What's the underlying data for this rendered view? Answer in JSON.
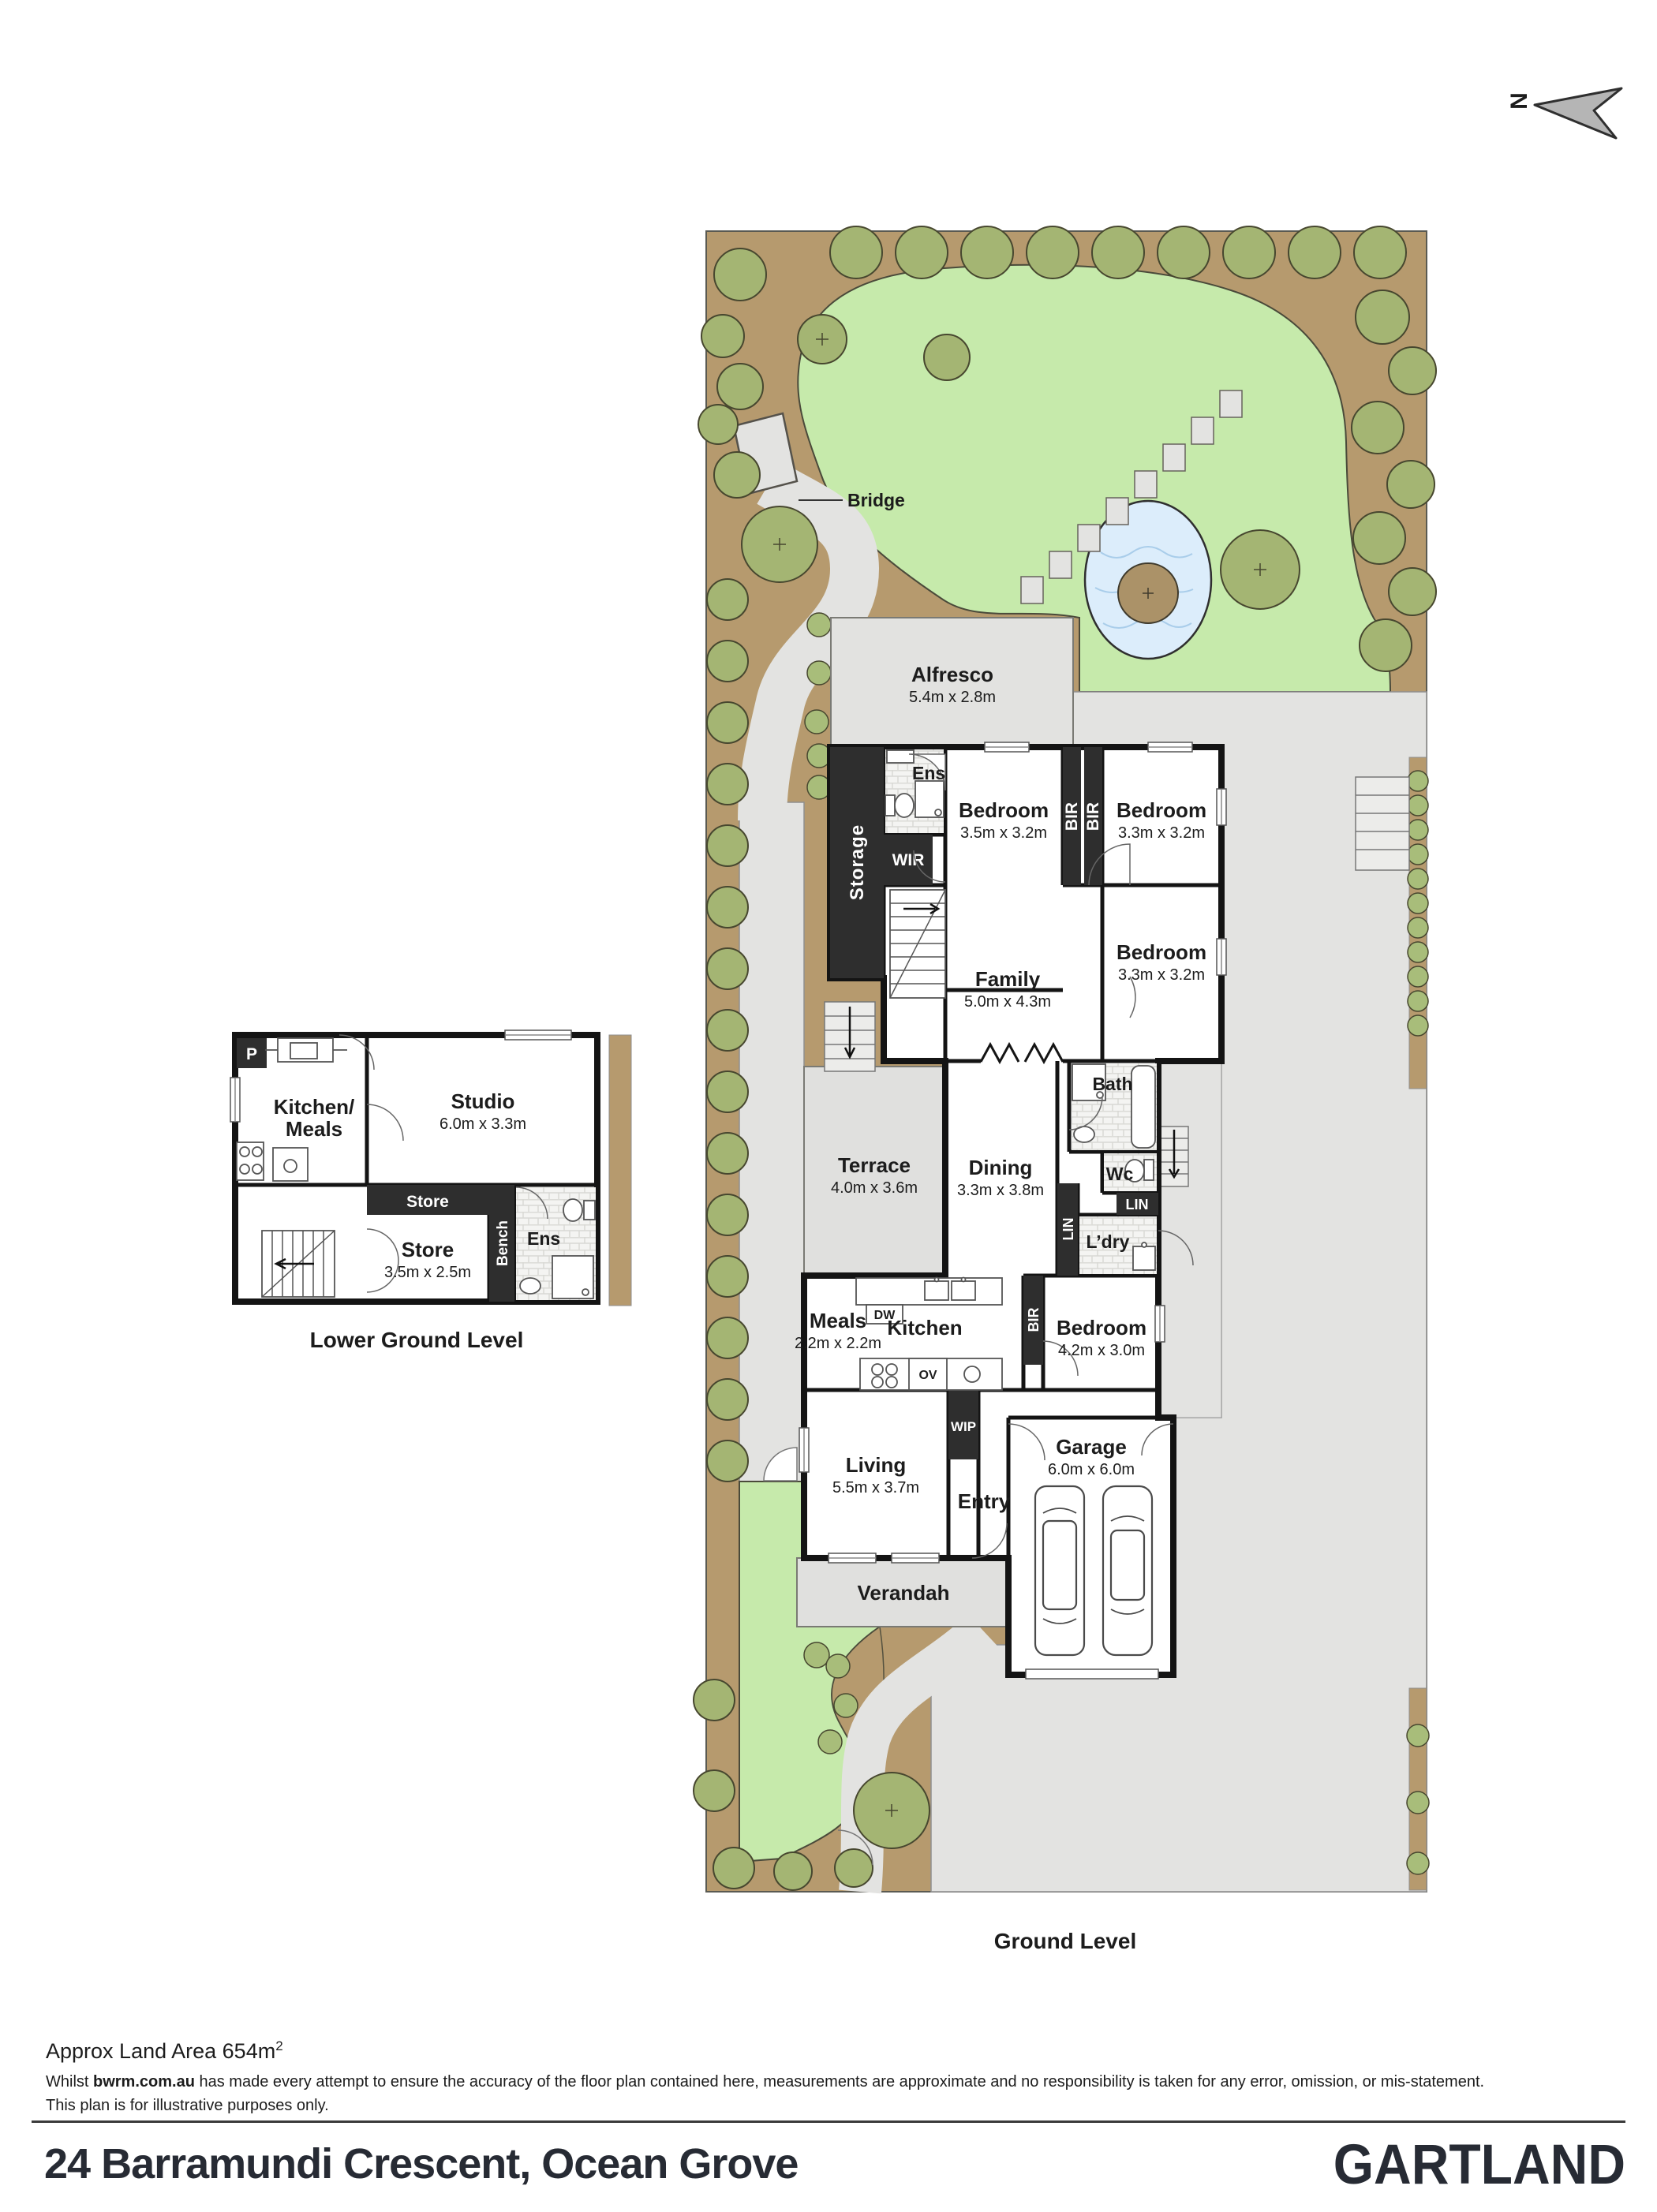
{
  "compass": {
    "n": "N"
  },
  "garden": {
    "bridge_label": "Bridge"
  },
  "ground": {
    "caption": "Ground Level",
    "alfresco": {
      "name": "Alfresco",
      "dims": "5.4m x 2.8m"
    },
    "storage": "Storage",
    "ens": "Ens",
    "wir": "WIR",
    "bir": "BIR",
    "bedroom1": {
      "name": "Bedroom",
      "dims": "3.5m x 3.2m"
    },
    "bedroom2": {
      "name": "Bedroom",
      "dims": "3.3m x 3.2m"
    },
    "bedroom3": {
      "name": "Bedroom",
      "dims": "3.3m x 3.2m"
    },
    "family": {
      "name": "Family",
      "dims": "5.0m x 4.3m"
    },
    "bath": "Bath",
    "wc": "Wc",
    "lin": "LIN",
    "ldry": "L’dry",
    "terrace": {
      "name": "Terrace",
      "dims": "4.0m x 3.6m"
    },
    "dining": {
      "name": "Dining",
      "dims": "3.3m x 3.8m"
    },
    "meals": {
      "name": "Meals",
      "dims": "2.2m x 2.2m"
    },
    "kitchen": "Kitchen",
    "dw": "DW",
    "ov": "OV",
    "wip": "WIP",
    "bedroom4": {
      "name": "Bedroom",
      "dims": "4.2m x 3.0m"
    },
    "living": {
      "name": "Living",
      "dims": "5.5m x 3.7m"
    },
    "entry": "Entry",
    "garage": {
      "name": "Garage",
      "dims": "6.0m x 6.0m"
    },
    "verandah": "Verandah"
  },
  "lower": {
    "caption": "Lower Ground Level",
    "p": "P",
    "kitchen_meals_1": "Kitchen/",
    "kitchen_meals_2": "Meals",
    "studio": {
      "name": "Studio",
      "dims": "6.0m x 3.3m"
    },
    "store_band": "Store",
    "store": {
      "name": "Store",
      "dims": "3.5m x 2.5m"
    },
    "bench": "Bench",
    "ens": "Ens"
  },
  "footer": {
    "land_area": "Approx Land Area 654m",
    "land_area_sup": "2",
    "disclaimer_prefix": "Whilst ",
    "disclaimer_domain": "bwrm.com.au",
    "disclaimer_rest": " has made every attempt to ensure the accuracy of the floor plan contained here, measurements are approximate and no responsibility is taken for any error, omission, or mis-statement.",
    "disclaimer_line2": "This plan is for illustrative purposes only.",
    "address": "24 Barramundi Crescent, Ocean Grove",
    "brand": "GARTLAND"
  },
  "colors": {
    "garden_bed": "#b69a6e",
    "lawn": "#c6eaab",
    "tree": "#a4b573",
    "pond": "#dcedfb",
    "path_gray": "#e3e3e1",
    "wall_black": "#141414",
    "feature_black": "#2e2e2e",
    "brand_text": "#272b34"
  }
}
